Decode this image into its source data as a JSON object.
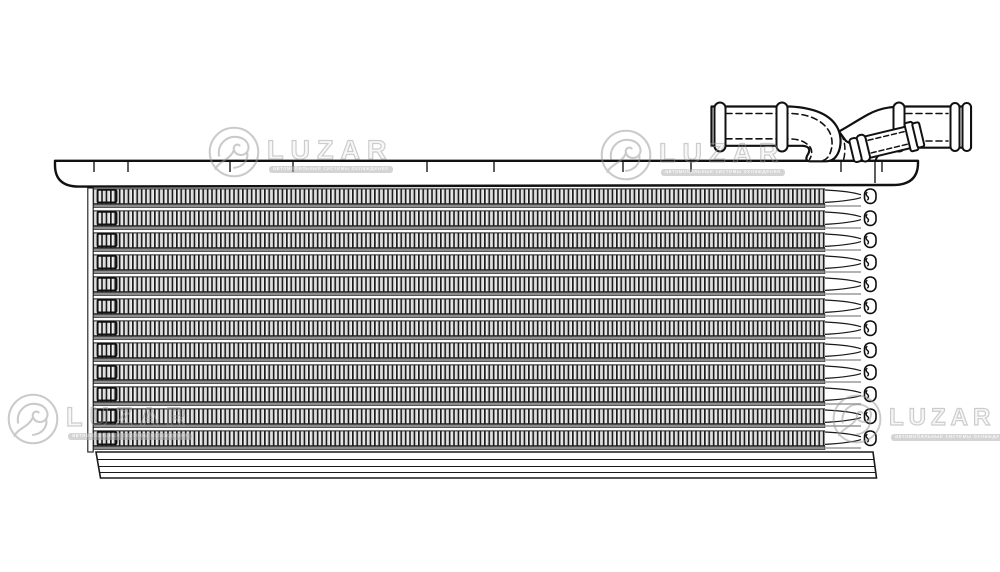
{
  "brand": {
    "name": "LUZAR",
    "tagline": "автомобильные системы охлаждения"
  },
  "colors": {
    "background": "#ffffff",
    "line": "#1a1a1a",
    "fin_dark": "#1c1c1c",
    "fin_light": "#f3f3f3",
    "tube_bar": "#8d8d8d",
    "tube_bar_light": "#b3b3b3",
    "watermark_gray": "#9b9b9b"
  },
  "drawing": {
    "description": "Technical line drawing of an intercooler / charge-air cooler: finned tube core, top tank plate with elbow hose fitting and angled branch stub, bottom plate",
    "core": {
      "rows": 12,
      "top": 188,
      "row_period": 22,
      "fin_band_height": 16,
      "left": 93,
      "fins_right": 825,
      "tube_cap_right": 877,
      "bottom": 452
    },
    "top_plate": {
      "left": 55,
      "right": 918,
      "top": 161,
      "bottom": 186,
      "tick_xs": [
        94,
        128,
        230,
        293,
        427,
        494,
        623,
        691,
        841,
        882
      ],
      "seam_x": 875
    },
    "bottom_plate": {
      "left": 96,
      "right": 873,
      "top": 452,
      "bottom": 478
    }
  }
}
